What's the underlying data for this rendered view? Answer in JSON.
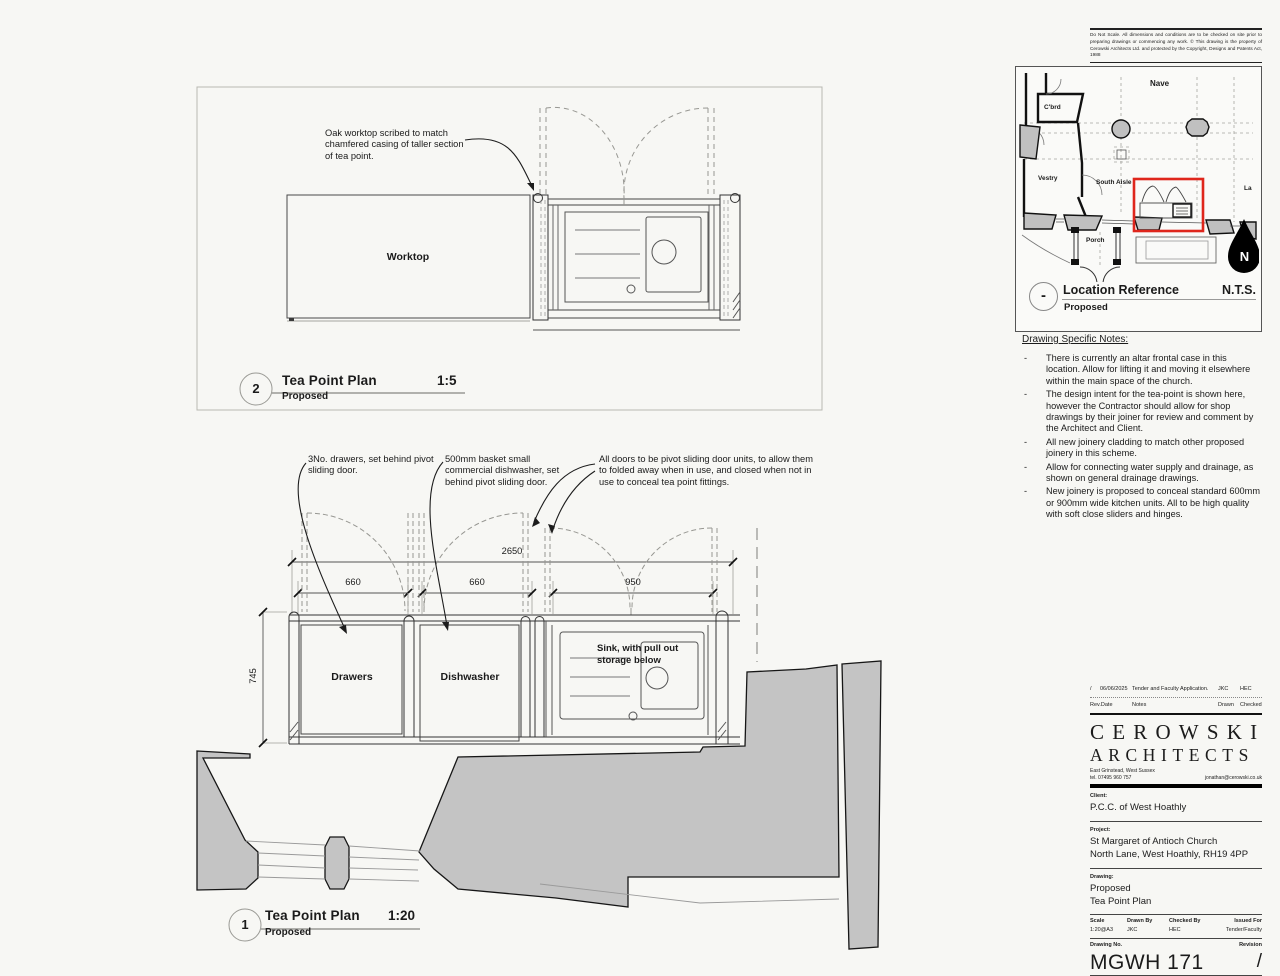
{
  "disclaimer": "Do Not Scale. All dimensions and conditions are to be checked on site prior to preparing drawings or commencing any work. © This drawing is the property of Cerowski Architects Ltd. and protected by the Copyright, Designs and Patents Act, 1988",
  "colors": {
    "highlight_red": "#df261c",
    "wall_gray": "#c4c4c4"
  },
  "location_ref": {
    "labels": {
      "nave": "Nave",
      "cbrd": "C'brd",
      "vestry": "Vestry",
      "south_aisle": "South Aisle",
      "la": "La",
      "porch": "Porch",
      "north": "N"
    },
    "marker": "-",
    "title": "Location Reference",
    "scale": "N.T.S.",
    "subtitle": "Proposed"
  },
  "notes": {
    "heading": "Drawing Specific Notes:",
    "bullet": "-",
    "items": [
      "There is currently an altar frontal case in this location.  Allow for lifting it and moving it elsewhere within the main space of the church.",
      "The design intent for the tea-point is shown here, however the Contractor should allow for shop drawings by their joiner for review and comment by the Architect and Client.",
      "All new joinery cladding to match other proposed joinery in this scheme.",
      "Allow for connecting water supply and drainage, as shown on general drainage drawings.",
      "New joinery is proposed to conceal standard 600mm or 900mm wide kitchen units.  All to be high quality with soft close sliders and hinges."
    ]
  },
  "drawing2": {
    "number": "2",
    "title": "Tea Point Plan",
    "scale": "1:5",
    "subtitle": "Proposed",
    "annotation": "Oak worktop scribed to match chamfered casing of taller section of tea point.",
    "worktop_label": "Worktop"
  },
  "drawing1": {
    "number": "1",
    "title": "Tea Point Plan",
    "scale": "1:20",
    "subtitle": "Proposed",
    "annotations": {
      "drawers": "3No. drawers, set behind pivot sliding door.",
      "dishwasher": "500mm basket small commercial dishwasher, set behind pivot sliding door.",
      "doors": "All doors to be pivot sliding door units, to allow them to folded away when in use, and closed when not in use to conceal tea point fittings."
    },
    "labels": {
      "drawers": "Drawers",
      "dishwasher": "Dishwasher",
      "sink": "Sink, with pull out storage below"
    },
    "dimensions": {
      "overall": "2650",
      "d1": "660",
      "d2": "660",
      "d3": "950",
      "height": "745"
    }
  },
  "titleblock": {
    "revision_row": {
      "rev": "/",
      "date": "06/06/2025",
      "notes": "Tender and Faculty Application.",
      "drawn": "JKC",
      "checked": "HEC"
    },
    "revision_headers": {
      "rev_date": "Rev.Date",
      "notes": "Notes",
      "drawn": "Drawn",
      "checked": "Checked"
    },
    "firm": {
      "name_line1": "CEROWSKI",
      "name_line2": "ARCHITECTS",
      "address": "East Grinstead, West Sussex",
      "tel": "tel. 07495 960 757",
      "email": "jonathan@cerowski.co.uk"
    },
    "client": {
      "label": "Client:",
      "value": "P.C.C. of West Hoathly"
    },
    "project": {
      "label": "Project:",
      "line1": "St Margaret of Antioch Church",
      "line2": "North Lane, West Hoathly, RH19 4PP"
    },
    "drawing": {
      "label": "Drawing:",
      "line1": "Proposed",
      "line2": "Tea Point Plan"
    },
    "meta": {
      "scale_label": "Scale",
      "scale": "1:20@A3",
      "drawn_label": "Drawn By",
      "drawn": "JKC",
      "checked_label": "Checked By",
      "checked": "HEC",
      "issued_label": "Issued For",
      "issued": "Tender/Faculty"
    },
    "number": {
      "label": "Drawing No.",
      "value": "MGWH 171",
      "rev_label": "Revision",
      "rev": "/"
    }
  }
}
